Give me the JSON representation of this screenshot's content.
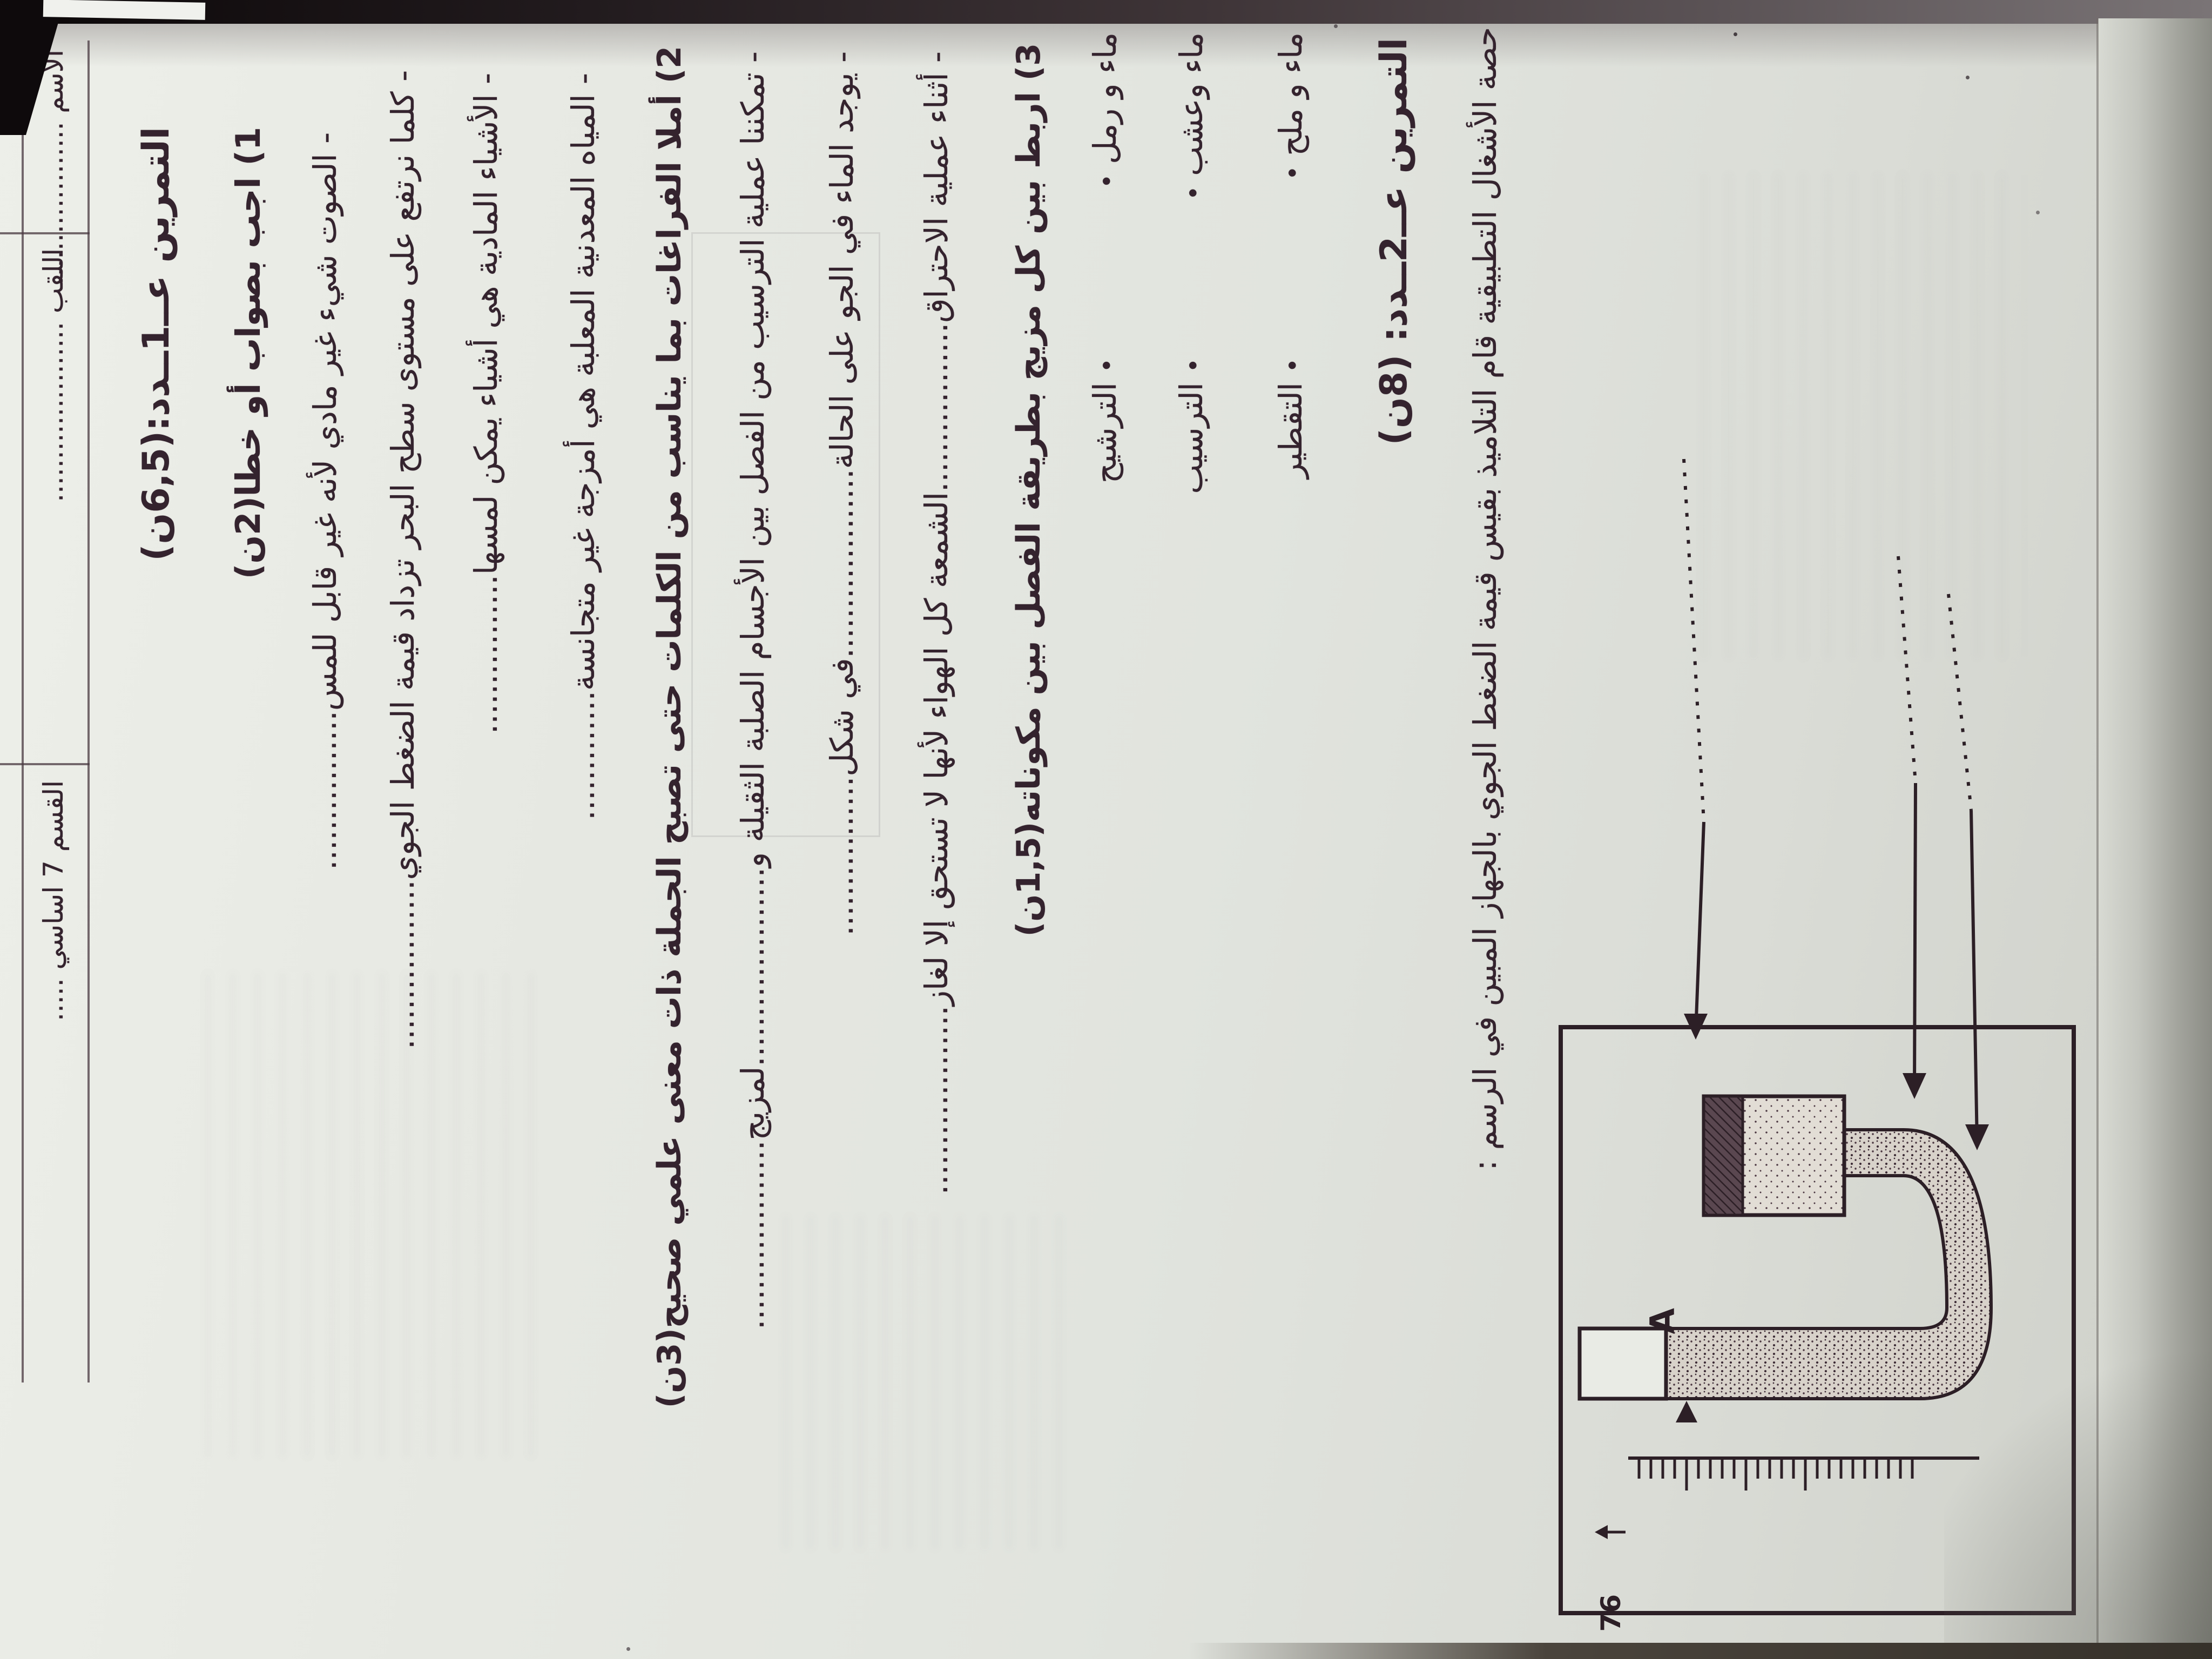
{
  "colors": {
    "ink": "#34232e",
    "paper": "#e3e5e0",
    "edge_dark": "#0e0a0c",
    "shadow": "#8b8c85"
  },
  "header": {
    "name_label": "الاسم",
    "name_dots": "...................",
    "surname_label": "اللقب",
    "surname_dots": ".....................",
    "class_label": "القسم 7 اساسي",
    "class_dots": "....."
  },
  "exercise1": {
    "title": "التمرين عــ1ــدد:(6,5ن)",
    "q1_heading": "1) اجب بصواب أو خطا(2ن)",
    "q1_items": [
      "- الصوت شيء غير مادي لأنه غير قابل للمس................",
      "- كلما نرتفع على مستوى سطح البحر تزداد قيمة الضغط الجوي.................",
      "- الأشياء المادية هي أشياء يمكن لمسها................",
      "- المياه المعدنية المعلبة هي أمزجة غير متجانسة............."
    ],
    "q2_heading": "2) أملا الفراغات بما يناسب من الكلمات حتى تصبح الجملة ذات معنى علمي صحيح(3ن)",
    "q2_items": [
      "- تمكننا عملية الترسيب من الفصل بين الأجسام الصلبة الثقيلة و....................لمزيج...................",
      "- يوجد الماء في الجو على الحالة...................في شكل................",
      "- أثناء عملية الاحتراق.................الشمعة كل الهواء لأنها لا تستحق إلا لغاز..................."
    ],
    "q3_heading": "3) اربط بين كل مزيج بطريقة الفصل بين مكوناته(1,5ن)",
    "bullet": "•",
    "match_rows": [
      {
        "mix": "ماء و رمل",
        "method": "الترشيح"
      },
      {
        "mix": "ماء وعشب",
        "method": "الترسيب"
      },
      {
        "mix": "ماء و ملح",
        "method": "التقطير"
      }
    ]
  },
  "exercise2": {
    "title": "التمرين عــ2ــدد: (8ن)",
    "intro": "حصة الأشغال التطبيقية قام التلاميذ بقيس قيمة الضغط الجوي بالجهاز المبين في الرسم :",
    "figure": {
      "point_label": "A",
      "scale_value": "76"
    }
  }
}
